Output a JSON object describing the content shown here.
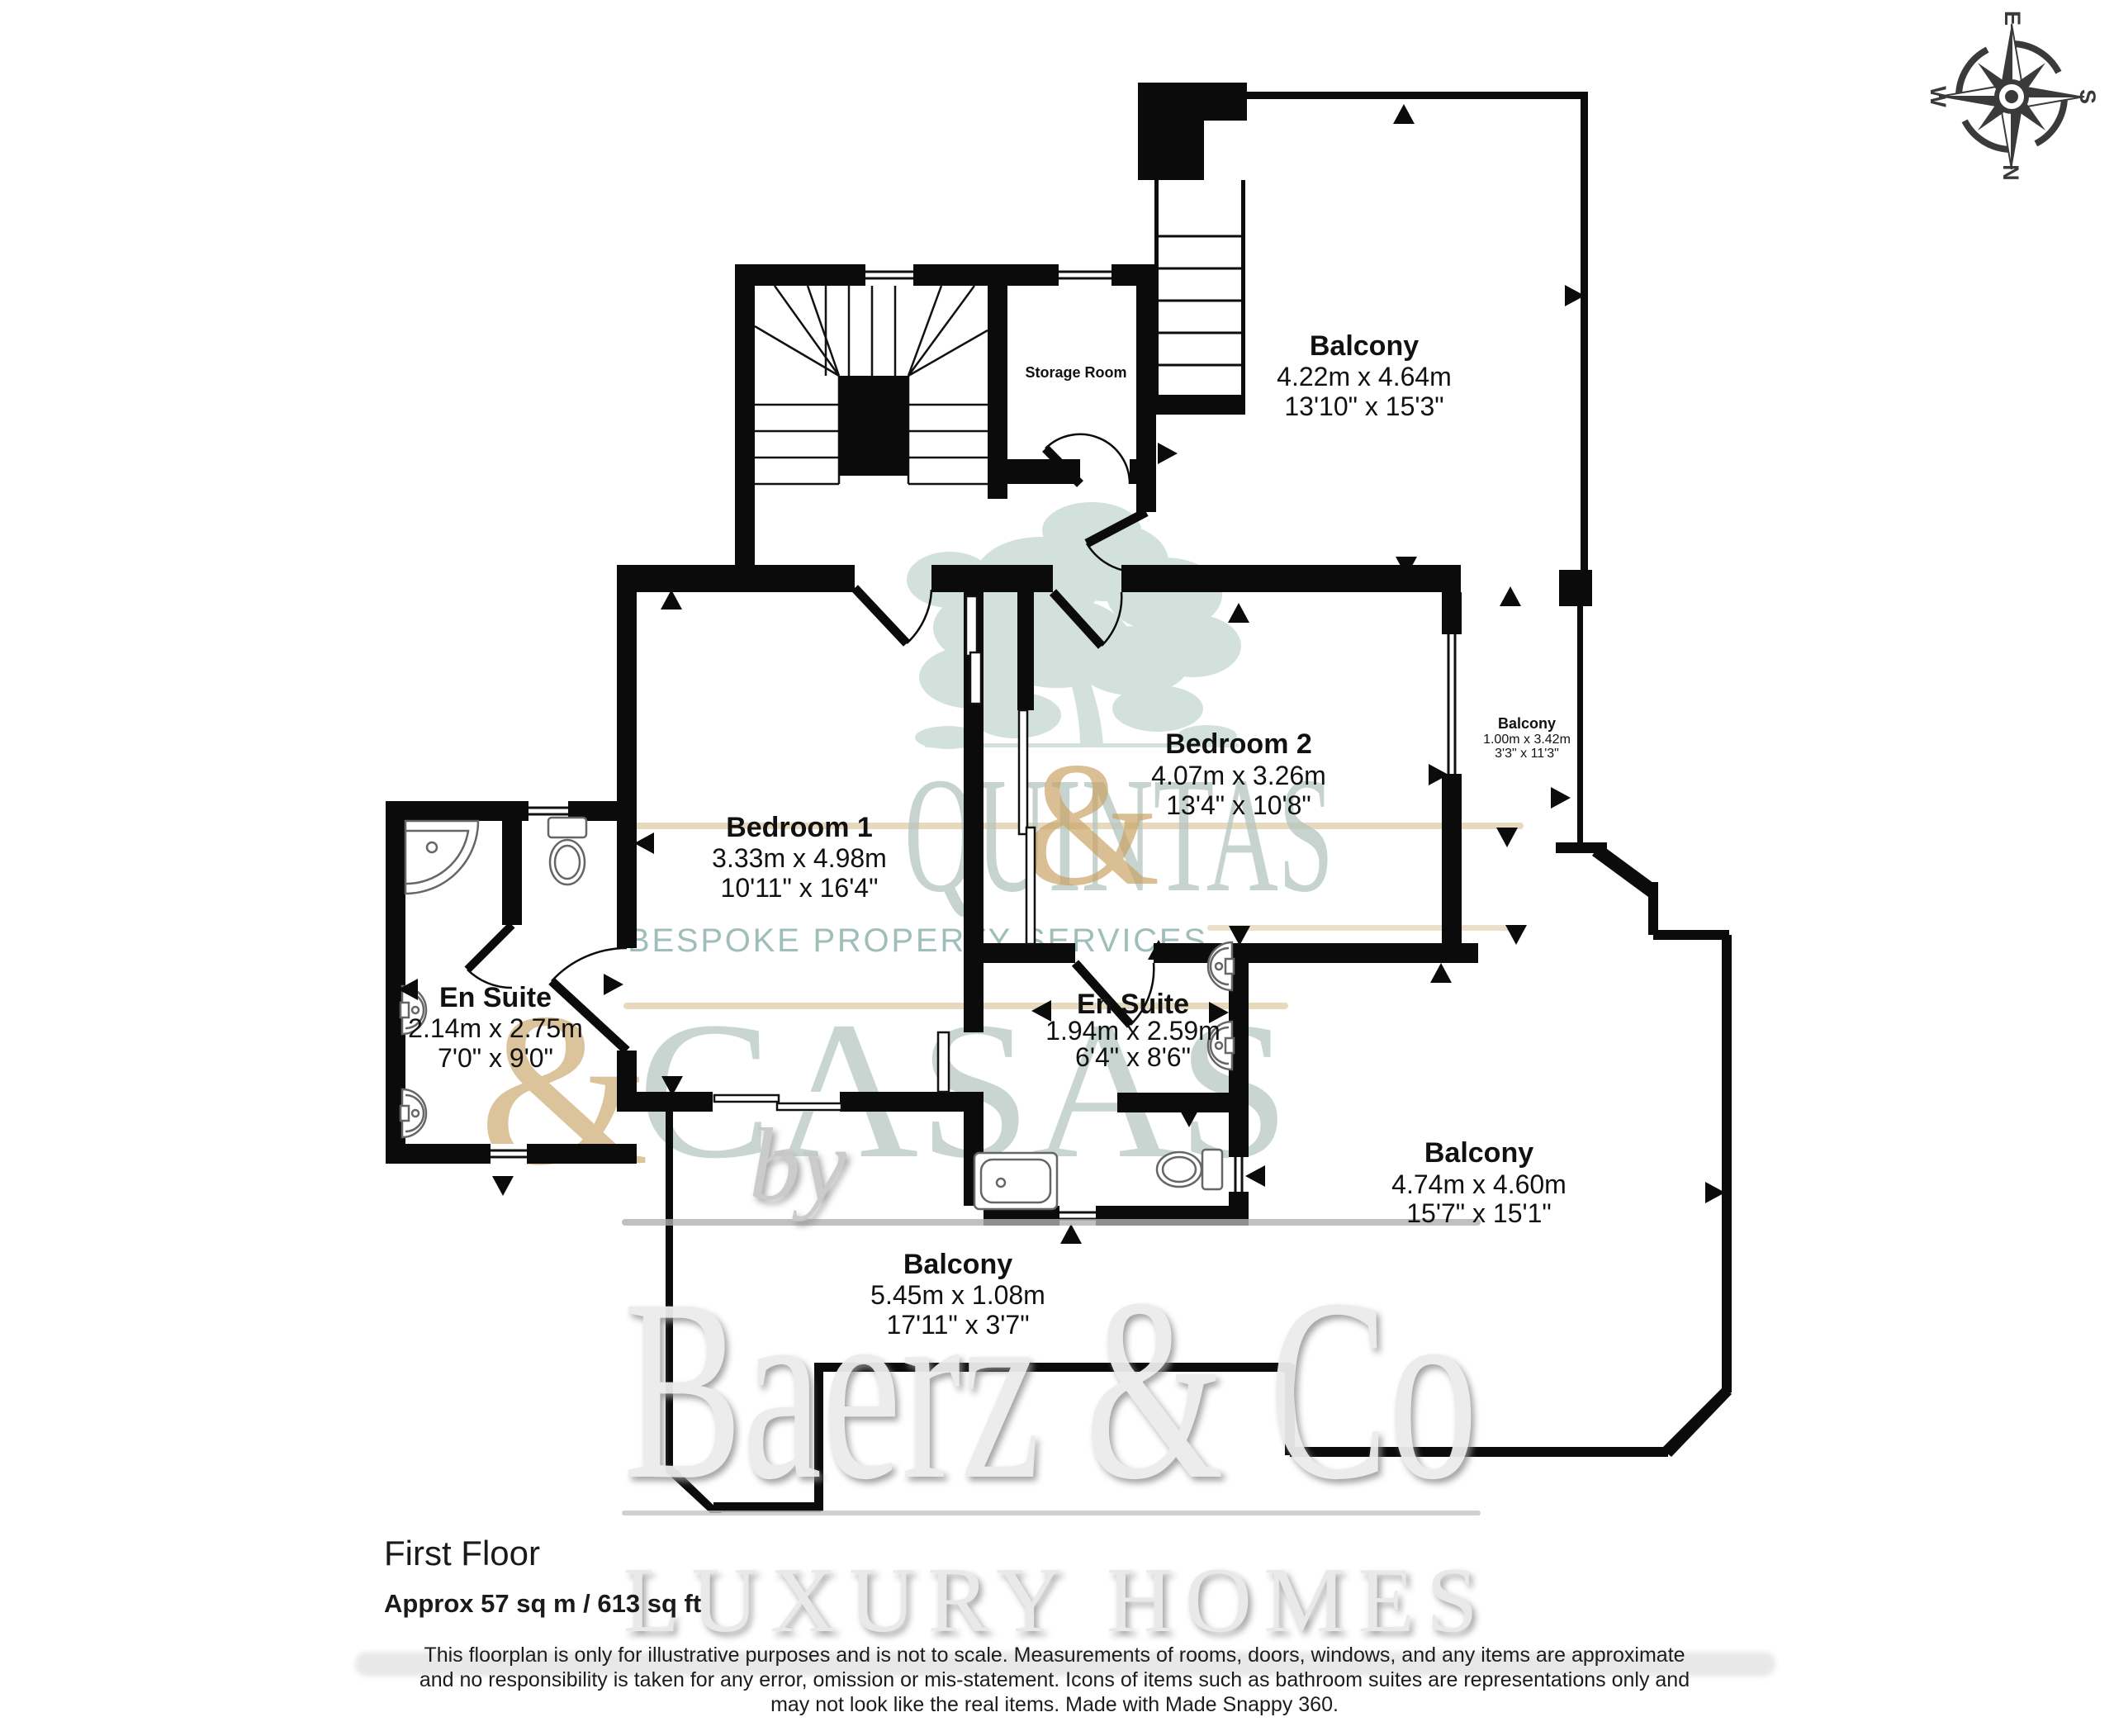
{
  "floor": {
    "title": "First Floor",
    "area": "Approx 57 sq m / 613 sq ft"
  },
  "rooms": {
    "balcony_top": {
      "name": "Balcony",
      "metric": "4.22m x 4.64m",
      "imperial": "13'10\" x 15'3\""
    },
    "storage": {
      "name": "Storage Room"
    },
    "bedroom2": {
      "name": "Bedroom 2",
      "metric": "4.07m x 3.26m",
      "imperial": "13'4\" x 10'8\""
    },
    "balcony_side": {
      "name": "Balcony",
      "metric": "1.00m x 3.42m",
      "imperial": "3'3\" x 11'3\""
    },
    "bedroom1": {
      "name": "Bedroom 1",
      "metric": "3.33m x 4.98m",
      "imperial": "10'11\" x 16'4\""
    },
    "ensuite1": {
      "name": "En Suite",
      "metric": "2.14m x 2.75m",
      "imperial": "7'0\" x 9'0\""
    },
    "ensuite2": {
      "name": "En Suite",
      "metric": "1.94m x 2.59m",
      "imperial": "6'4\" x 8'6\""
    },
    "balcony_right": {
      "name": "Balcony",
      "metric": "4.74m x 4.60m",
      "imperial": "15'7\" x 15'1\""
    },
    "balcony_bottom": {
      "name": "Balcony",
      "metric": "5.45m x 1.08m",
      "imperial": "17'11\" x 3'7\""
    }
  },
  "compass": {
    "n": "N",
    "e": "E",
    "s": "S",
    "w": "W"
  },
  "watermark": {
    "logo_line1": "QUINTAS",
    "logo_amp": "&",
    "logo_line2": "CASAS",
    "tagline": "BESPOKE PROPERTY SERVICES",
    "by": "by",
    "brand": "Baerz & Co",
    "brand_sub": "LUXURY HOMES"
  },
  "disclaimer": [
    "This floorplan is only for illustrative purposes and is not to scale. Measurements of rooms, doors, windows, and any items are approximate",
    "and no responsibility is taken for any error, omission or mis-statement. Icons of items such as bathroom suites are representations only and",
    "may not look like the real items. Made with Made Snappy 360."
  ],
  "colors": {
    "wall": "#0b0b0b",
    "watermark_teal": "#b8c7c2",
    "watermark_gold": "#c9a566",
    "watermark_gray": "#ececec",
    "tagline_teal": "#8fb3ad"
  }
}
